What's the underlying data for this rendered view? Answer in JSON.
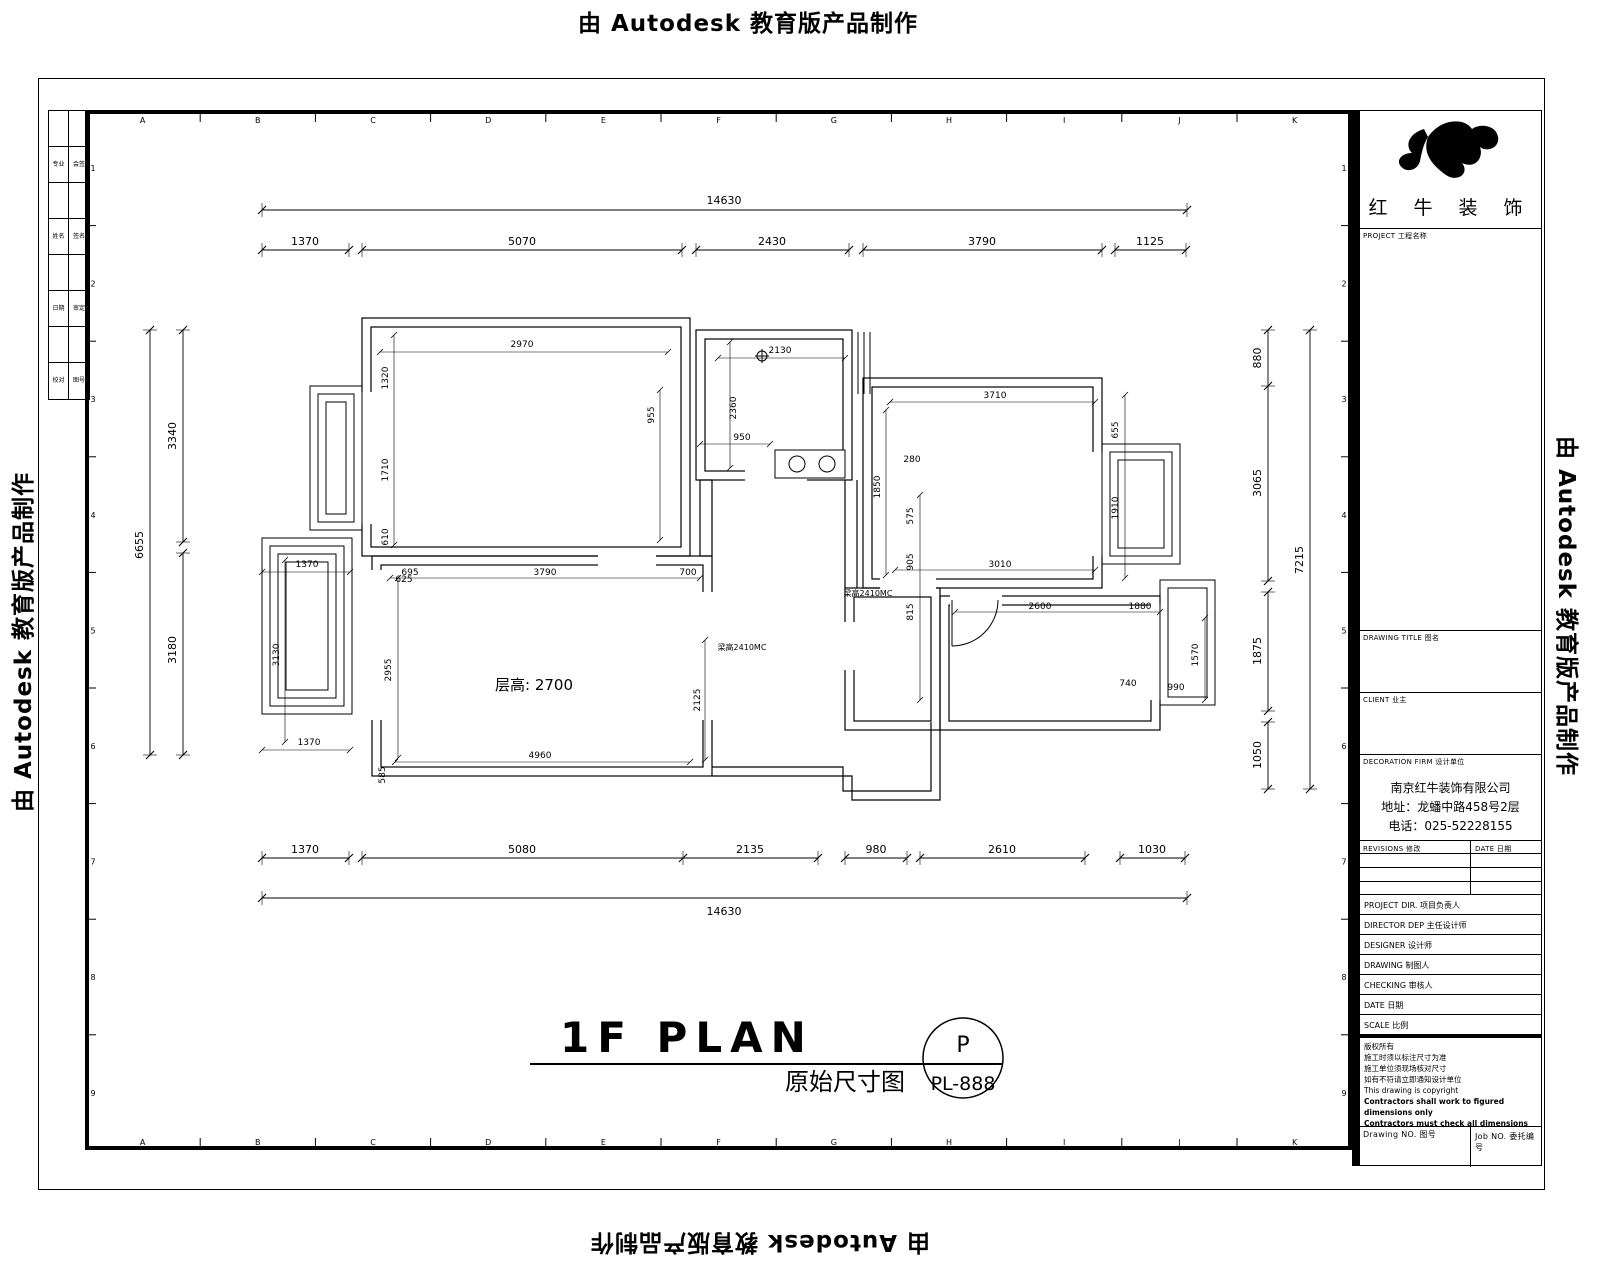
{
  "watermark": {
    "text": "由 Autodesk 教育版产品制作"
  },
  "plan_title": {
    "main": "1F PLAN",
    "sub": "原始尺寸图",
    "bubble_top": "P",
    "bubble_bottom": "PL-888"
  },
  "plan": {
    "floor_height": "层高: 2700",
    "small_dims": [
      "2970",
      "1320",
      "1710",
      "610",
      "955",
      "2130",
      "2360",
      "950",
      "3710",
      "1850",
      "280",
      "655",
      "1910",
      "3010",
      "575",
      "905",
      "815",
      "695",
      "3790",
      "700",
      "4960",
      "2955",
      "1370",
      "1370",
      "3130",
      "625",
      "585",
      "2600",
      "1880",
      "1570",
      "740",
      "990",
      "2125",
      "梁高2410MC",
      "梁高2410MC"
    ]
  },
  "dims": {
    "top_total": "14630",
    "top_segments": [
      "1370",
      "5070",
      "2430",
      "3790",
      "1125"
    ],
    "bottom_segments": [
      "1370",
      "5080",
      "2135",
      "980",
      "2610",
      "1030"
    ],
    "bottom_total": "14630",
    "left_total": "6655",
    "left_segments": [
      "3340",
      "3180"
    ],
    "right_segments": [
      "880",
      "3065",
      "1875",
      "1050"
    ],
    "right_total": "7215"
  },
  "grid": {
    "letters": [
      "A",
      "B",
      "C",
      "D",
      "E",
      "F",
      "G",
      "H",
      "I",
      "J",
      "K"
    ],
    "numbers": [
      "1",
      "2",
      "3",
      "4",
      "5",
      "6",
      "7",
      "8",
      "9"
    ]
  },
  "signoff": {
    "rows": [
      [
        "专业",
        "会签"
      ],
      [
        "姓名",
        "签名"
      ],
      [
        "日期",
        "审定"
      ],
      [
        "校对",
        "图号"
      ]
    ]
  },
  "title_block": {
    "logo_text": "红 牛 装 饰",
    "project_label": "PROJECT 工程名称",
    "drawing_title_label": "DRAWING TITLE 图名",
    "client_label": "CLIENT 业主",
    "firm_label": "DECORATION FIRM 设计单位",
    "firm_lines": [
      "南京红牛装饰有限公司",
      "地址：龙蟠中路458号2层",
      "电话：025-52228155"
    ],
    "revisions_label": "REVISIONS 修改",
    "date_col_label": "DATE 日期",
    "staff_rows": [
      "PROJECT DIR. 项目负责人",
      "DIRECTOR DEP 主任设计师",
      "DESIGNER 设计师",
      "DRAWING 制图人",
      "CHECKING 审核人",
      "DATE 日期",
      "SCALE 比例"
    ],
    "notes": [
      "版权所有",
      "施工时须以标注尺寸为准",
      "施工单位须现场核对尺寸",
      "如有不符请立即通知设计单位",
      "This drawing is copyright",
      "Contractors shall work to figured dimensions only",
      "Contractors must check all dimensions on site",
      "Omissions must be reported immediately to architect"
    ],
    "drawing_no_label": "Drawing NO. 图号",
    "job_no_label": "Job NO. 委托编号"
  }
}
